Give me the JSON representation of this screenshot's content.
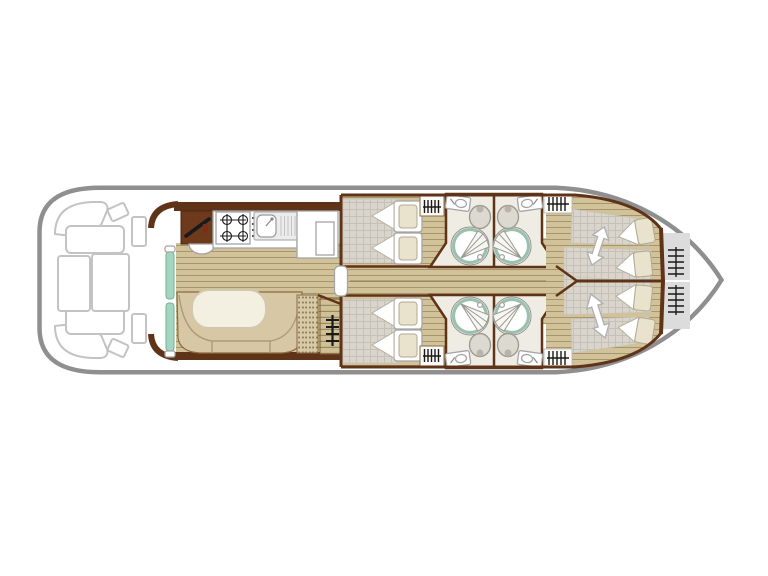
{
  "diagram": {
    "type": "boat-deck-plan",
    "orientation": "bow-right"
  },
  "colors": {
    "hull_outline": "#8f8f8f",
    "deck_furniture_outline": "#c3c3c3",
    "wall_brown": "#5f3317",
    "cabinet_brown": "#6e3a1c",
    "floor_wood": "#d2c299",
    "floor_plank_line": "#a6966e",
    "bed_grey": "#d9d5cc",
    "bed_grid_line": "#c6c1b6",
    "pillow_beige": "#e9e2cc",
    "bench_tan": "#d8c7a4",
    "dotted_bench_tan": "#d7caa5",
    "steps_tan": "#cfc096",
    "steps_line": "#9a8a5f",
    "table_cream": "#f4f0e1",
    "sliding_door_teal": "#a3d6c1",
    "bathroom_floor": "#efece3",
    "shower_ring_teal": "#9cc0ae",
    "toilet_grey": "#dcd9d0",
    "locker_grey": "#dcdcdc",
    "fixture_outline": "#a5a5a5",
    "symbol_black": "#1a1a1a"
  },
  "areas": {
    "stern_deck": {
      "fixtures": [
        "corner-seat",
        "corner-seat",
        "bench",
        "bench",
        "sun-pad",
        "sun-pad",
        "step-pad",
        "step-pad",
        "side-locker",
        "side-locker"
      ]
    },
    "galley": {
      "fixtures": [
        "helm-station",
        "helm-seat",
        "stove",
        "sink",
        "counter",
        "fridge-cupboard"
      ]
    },
    "saloon": {
      "fixtures": [
        "sliding-door",
        "u-sofa",
        "dinette-table",
        "side-bench",
        "companionway-steps"
      ]
    },
    "mid_cabins": [
      {
        "fixtures": [
          "double-bed",
          "pillow",
          "pillow",
          "hanging-locker"
        ]
      },
      {
        "fixtures": [
          "double-bed",
          "pillow",
          "pillow",
          "hanging-locker"
        ]
      }
    ],
    "bathrooms": [
      {
        "fixtures": [
          "washbasin",
          "toilet",
          "round-shower"
        ]
      },
      {
        "fixtures": [
          "washbasin",
          "toilet",
          "round-shower"
        ]
      },
      {
        "fixtures": [
          "washbasin",
          "toilet",
          "round-shower"
        ]
      },
      {
        "fixtures": [
          "washbasin",
          "toilet",
          "round-shower"
        ]
      }
    ],
    "fore_cabins": [
      {
        "fixtures": [
          "sliding-bed",
          "sliding-bed",
          "slide-arrow",
          "pillow",
          "pillow",
          "hanging-locker"
        ]
      },
      {
        "fixtures": [
          "sliding-bed",
          "sliding-bed",
          "slide-arrow",
          "pillow",
          "pillow",
          "hanging-locker"
        ]
      }
    ],
    "bow": {
      "fixtures": [
        "storage-locker",
        "storage-locker",
        "hanging-locker",
        "hanging-locker"
      ]
    }
  }
}
